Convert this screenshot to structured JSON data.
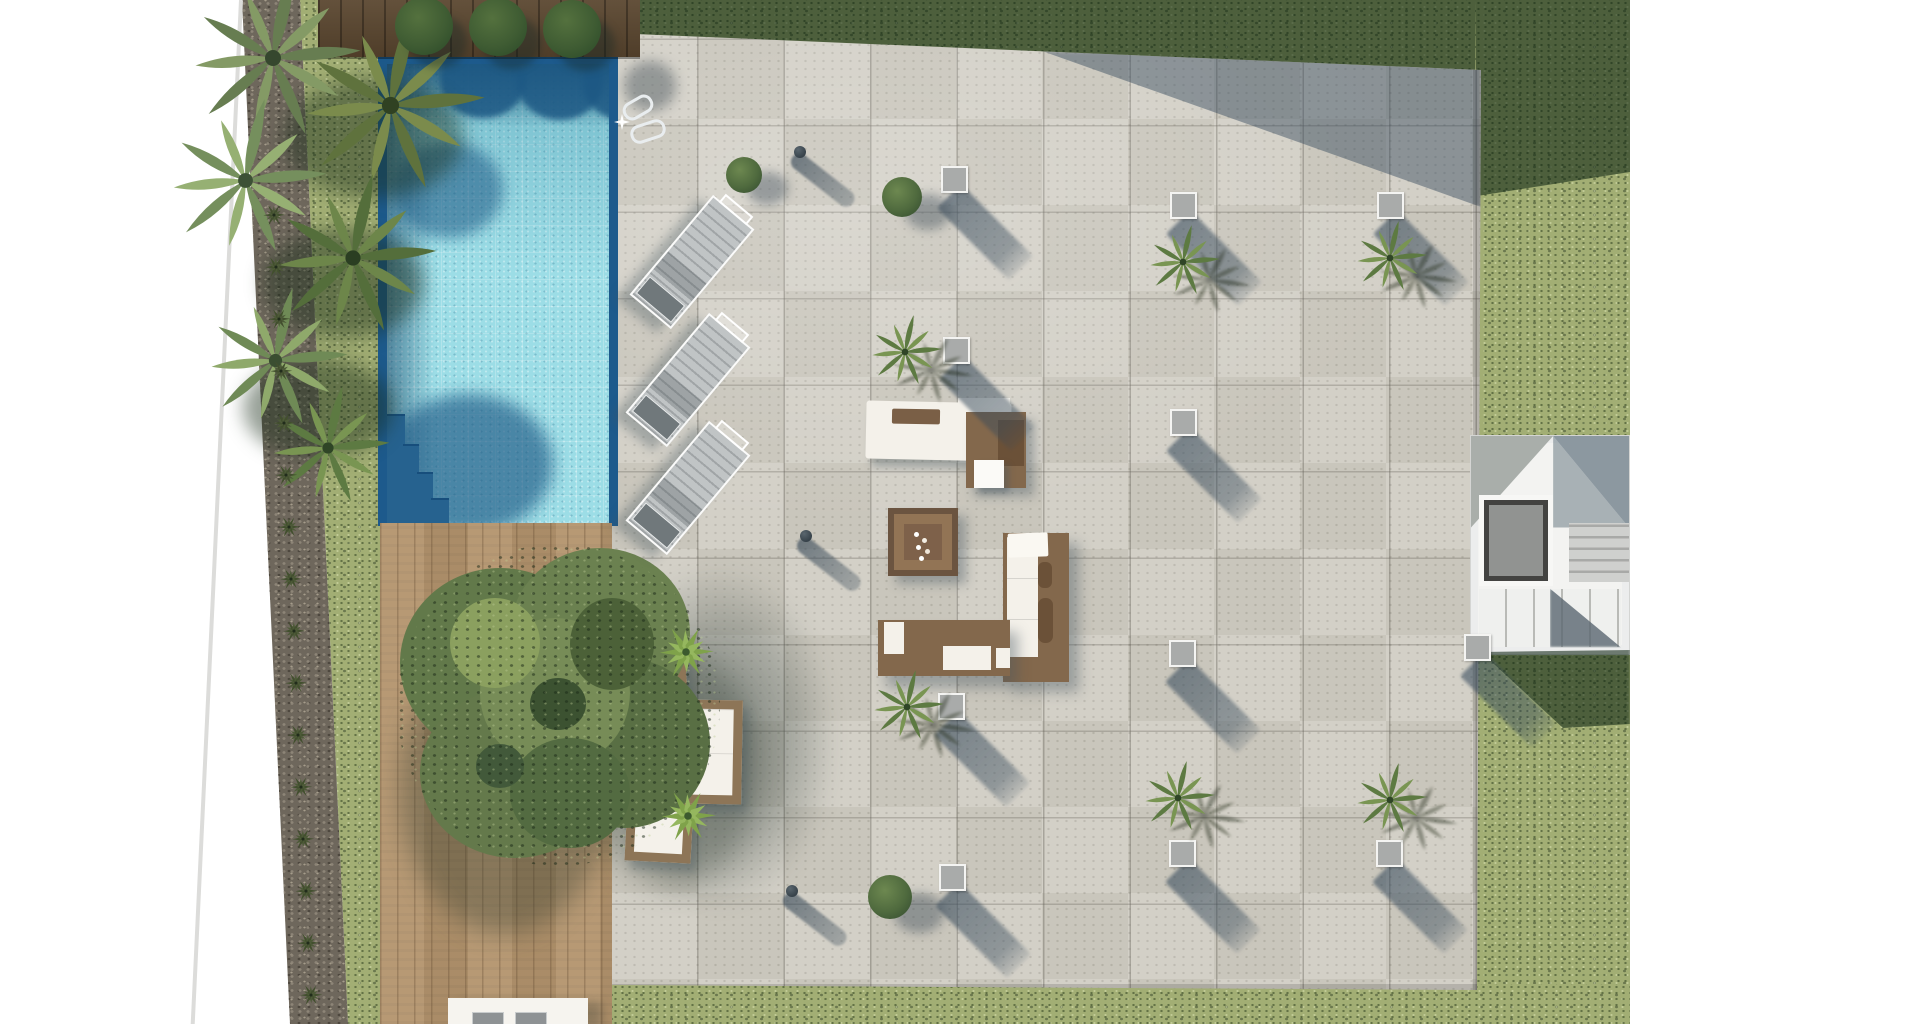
{
  "palette": {
    "background": "#ffffff",
    "grass": "#a2ae74",
    "grass_shadow": "#15351c",
    "gravel": "#6e675c",
    "pool_trim": "#1d5a8c",
    "water_light": "#9cdde6",
    "water_shadow": "#1d5884",
    "planter_wood": "#5a462f",
    "deck_wood": "#b3946d",
    "tile": "#d0cdc3",
    "shadow_blue": "#3a4e60",
    "light_square": "#a9abaa",
    "lounger_fabric": "#c0c4c5",
    "wicker": "#8d7557",
    "cushion": "#f4f1ea",
    "sofa_wood": "#83684c",
    "pillow_brown": "#6b5138",
    "palm_dark": "#5d7a42",
    "palm_light": "#799552",
    "tree_green": "#62794a",
    "agave": "#7fa24a",
    "stair_surface": "#eceded",
    "elevator_dark": "#434341",
    "elevator_cab": "#919391"
  },
  "scene": {
    "floor_lights": [
      [
        941,
        166
      ],
      [
        1170,
        192
      ],
      [
        1377,
        192
      ],
      [
        943,
        337
      ],
      [
        1170,
        409
      ],
      [
        1464,
        634
      ],
      [
        1169,
        640
      ],
      [
        938,
        693
      ],
      [
        1169,
        840
      ],
      [
        1376,
        840
      ],
      [
        939,
        864
      ]
    ],
    "palm_trees": [
      [
        1183,
        262
      ],
      [
        1390,
        258
      ],
      [
        905,
        352
      ],
      [
        907,
        707
      ],
      [
        1178,
        798
      ],
      [
        1390,
        800
      ]
    ],
    "bushes": [
      [
        744,
        175,
        18
      ],
      [
        902,
        197,
        20
      ],
      [
        890,
        897,
        22
      ]
    ],
    "bollard_lights": [
      [
        800,
        152
      ],
      [
        806,
        536
      ],
      [
        792,
        891
      ]
    ],
    "sun_loungers": [
      [
        692,
        262,
        40
      ],
      [
        688,
        380,
        40
      ],
      [
        688,
        488,
        40
      ]
    ],
    "agave_plants": [
      [
        686,
        652
      ],
      [
        688,
        816
      ]
    ],
    "planter_bushes": [
      [
        424,
        26
      ],
      [
        498,
        27
      ],
      [
        572,
        29
      ]
    ],
    "gravel_plants": [
      [
        274,
        215
      ],
      [
        276,
        267
      ],
      [
        279,
        319
      ],
      [
        281,
        371
      ],
      [
        284,
        423
      ],
      [
        286,
        475
      ],
      [
        289,
        527
      ],
      [
        291,
        579
      ],
      [
        294,
        631
      ],
      [
        296,
        683
      ],
      [
        298,
        735
      ],
      [
        301,
        787
      ],
      [
        303,
        839
      ],
      [
        306,
        891
      ],
      [
        308,
        943
      ],
      [
        311,
        995
      ]
    ]
  }
}
